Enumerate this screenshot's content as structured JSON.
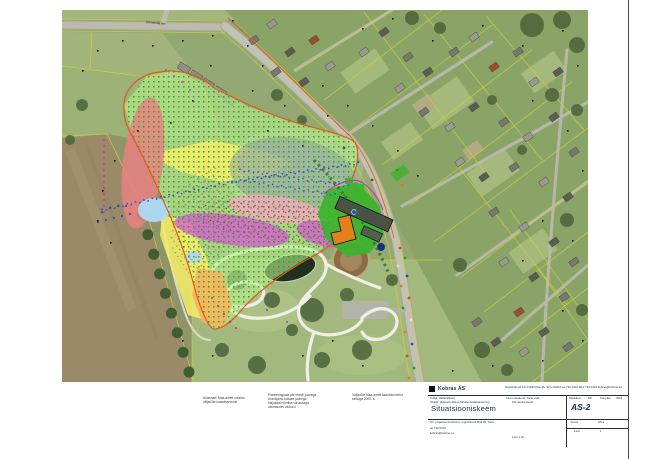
{
  "page": {
    "background": "#ffffff",
    "frame_color": "#4a4a4a"
  },
  "map": {
    "road_label": "Kõrveküla tee",
    "palette": {
      "photo_green": "#93a873",
      "photo_light_green": "#a9bd7f",
      "photo_field_brown": "#9b8a68",
      "road_gray": "#c2c2b4",
      "path_white": "#efefe7",
      "cadastral_yellow": "#d2d232",
      "zone_green": "#b7ee8d",
      "zone_green_dots": "#2f9e1f",
      "zone_yellow": "#f5ef6a",
      "zone_orange": "#f4b45e",
      "zone_salmon": "#e88181",
      "zone_blue": "#aed9f2",
      "zone_magenta": "#d956d9",
      "zone_pink": "#f2a8c0",
      "zone_teal": "#8ea39b",
      "boundary_orange": "#e05a18",
      "school_green": "#3cb32c",
      "building_orange": "#e2801c",
      "building_dark": "#4a5248",
      "water_dark": "#20301f",
      "stream_blue": "#2a50c8",
      "marker_magenta": "#d020d0"
    }
  },
  "notes": {
    "block_a": [
      "Aluskaart: Maa-ameti ortofoto",
      "väljavõte kaardiserverist"
    ],
    "block_b": [
      "Planeeringuala piir oranži joonega",
      "krundipiirid kollase joonega",
      "haljasala rohelise viirutusega",
      "olemasolev olukord"
    ],
    "block_c": [
      "Väljavõte Maa-ameti kaardiserverist",
      "seisuga 2009. a."
    ]
  },
  "titleblock": {
    "logo_text": "Kobras AS",
    "top_right_text": "Registrikood 10171636  Riia 35, Tartu 50410  tel 730 0310  faks 730 0315  kobras@kobras.ee",
    "client_line": "Tellija: Vallavalitsus",
    "object_line": "Objekt: jäätmehoidla ja lähiala detailplaneering",
    "location_line": "Tartu maakond, Tartu vald",
    "location_line2": "Kõrveküla alevik",
    "main_title": "Situatsiooniskeem",
    "stage_label": "Staadium",
    "stage_value": "DP",
    "date_label": "Kuupäev",
    "date_value": "2009",
    "drawing_number": "AS-2",
    "firm_line": "OÜ projekteerimisbüroo  registrikood  Riia 35, Tartu",
    "firm_line2": "tel 730 0310",
    "firm_line3": "kobras@kobras.ee",
    "bottom_center": "Leht 1 (1)",
    "sheet_label": "Joonis",
    "sheet_value": "AS-2",
    "sheets_label": "Leht",
    "sheets_value": "1"
  }
}
